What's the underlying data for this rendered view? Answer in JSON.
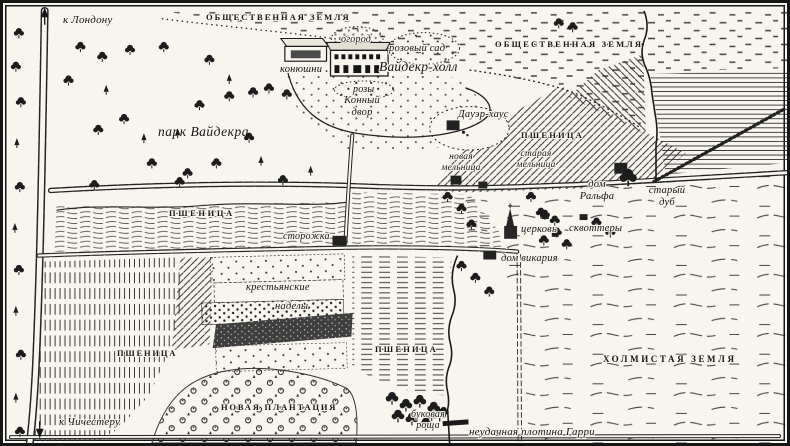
{
  "map": {
    "colors": {
      "paper": "#f7f5ee",
      "ink": "#1a1a1a"
    },
    "labels": {
      "to_london": "к Лондону",
      "common_land_top": "ОБЩЕСТВЕННАЯ ЗЕМЛЯ",
      "common_land_right": "ОБЩЕСТВЕННАЯ ЗЕМЛЯ",
      "kitchen_garden": "огород",
      "rose_garden": "розовый сад",
      "stables": "конюшни",
      "wideacre_hall": "Вайдекр-холл",
      "roses": "розы",
      "horse_yard": "Конный\nдвор",
      "dower_house": "Дауэр-хаус",
      "park": "парк Вайдекра",
      "wheat": "ПШЕНИЦА",
      "new_mill": "новая\nмельница",
      "old_mill": "старая\nмельница",
      "ralphs_house": "дом\nРальфа",
      "old_oak": "старый\nдуб",
      "church": "церковь",
      "squatters": "сквоттеры",
      "vicars_house": "дом викария",
      "lodge": "сторожка",
      "allotments_line1": "крестьянские",
      "allotments_line2": "наделы",
      "new_plantation": "НОВАЯ ПЛАНТАЦИЯ",
      "to_chichester": "к Чичестеру",
      "beech_grove": "буковая\nроща",
      "harrys_dam": "неудачная плотина Гарри",
      "hilly_land": "ХОЛМИСТАЯ ЗЕМЛЯ"
    }
  }
}
